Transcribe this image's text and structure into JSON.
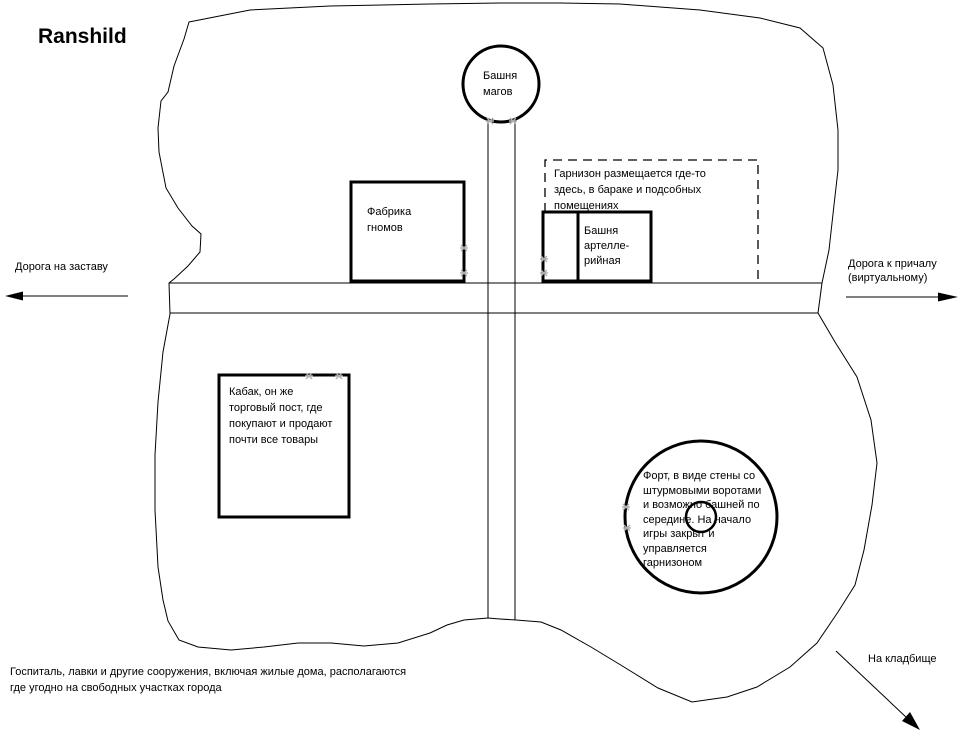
{
  "title": "Ranshild",
  "colors": {
    "ink": "#000000",
    "background": "#ffffff",
    "anchor_marker": "#b0b0b0"
  },
  "landmarks": {
    "mage_tower": {
      "lines": [
        "Башня",
        "магов"
      ]
    },
    "gnome_factory": {
      "lines": [
        "Фабрика",
        "гномов"
      ]
    },
    "garrison_note": {
      "lines": [
        "Гарнизон размещается где-то",
        "здесь, в бараке и подсобных",
        "помещениях"
      ]
    },
    "artillery_tower": {
      "lines": [
        "Башня",
        "артелле-",
        "рийная"
      ]
    },
    "tavern": {
      "lines": [
        "Кабак, он же",
        "торговый пост, где",
        "покупают и продают",
        "почти все товары"
      ]
    },
    "fort": {
      "lines": [
        "Форт, в виде стены со",
        "штурмовыми воротами",
        "и возможно башней по",
        "середине. На начало",
        "игры закрыт и",
        "управляется",
        "гарнизоном"
      ]
    }
  },
  "roads": {
    "west_arrow_label": "Дорога на заставу",
    "east_arrow_label_lines": [
      "Дорога к причалу",
      "(виртуальному)"
    ],
    "cemetery_arrow_label": "На кладбище"
  },
  "footnote_lines": [
    "Госпиталь, лавки и другие сооружения, включая жилые дома, располагаются",
    "где угодно на свободных участках города"
  ]
}
